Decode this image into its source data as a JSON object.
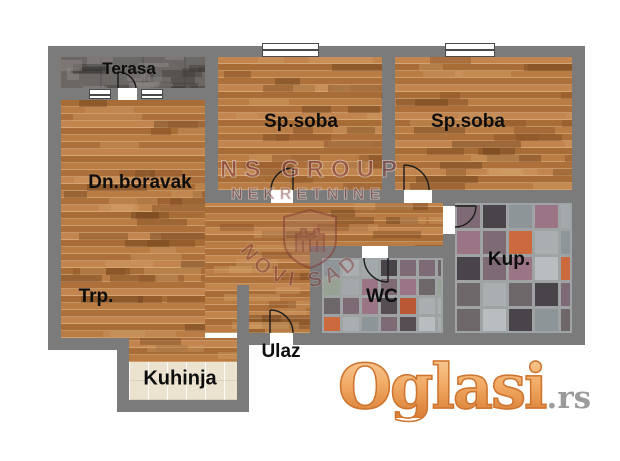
{
  "floorplan": {
    "rooms": [
      {
        "id": "terasa",
        "label": "Terasa"
      },
      {
        "id": "dn_boravak",
        "label": "Dn.boravak"
      },
      {
        "id": "sp_soba_1",
        "label": "Sp.soba"
      },
      {
        "id": "sp_soba_2",
        "label": "Sp.soba"
      },
      {
        "id": "trp",
        "label": "Trp."
      },
      {
        "id": "wc",
        "label": "WC"
      },
      {
        "id": "kup",
        "label": "Kup."
      },
      {
        "id": "ulaz",
        "label": "Ulaz"
      },
      {
        "id": "kuhinja",
        "label": "Kuhinja"
      }
    ],
    "watermark": {
      "line1": "NS GROUP",
      "line2": "NEKRETNINE",
      "arc_text": "NOVI SAD",
      "color": "rgba(122,44,44,0.5)"
    },
    "colors": {
      "wall": "#7b7b7b",
      "wood_base": "#b87c44",
      "terasa_floor": "#6b6765",
      "kitchen_tile": "#ebe3d0",
      "mosaic_grout": "#9fa3a4",
      "mosaic_palette": [
        "#b9bdbf",
        "#a3a8aa",
        "#8d9598",
        "#6e676a",
        "#564e52",
        "#cb6a3e",
        "#b95834",
        "#9b7485",
        "#7d6a75",
        "#49444a",
        "#a9aeb0",
        "#97a194"
      ],
      "wood_patch_palette": [
        "rgba(140,85,40,0.45)",
        "rgba(205,155,100,0.40)",
        "rgba(120,70,30,0.40)",
        "rgba(215,165,110,0.35)",
        "rgba(95,55,22,0.35)"
      ],
      "concrete_patch_palette": [
        "rgba(40,38,36,0.35)",
        "rgba(132,128,124,0.50)",
        "rgba(58,54,52,0.40)",
        "rgba(148,143,138,0.45)"
      ]
    }
  },
  "branding": {
    "logo_text": "Oglasi",
    "logo_suffix": ".rs"
  }
}
